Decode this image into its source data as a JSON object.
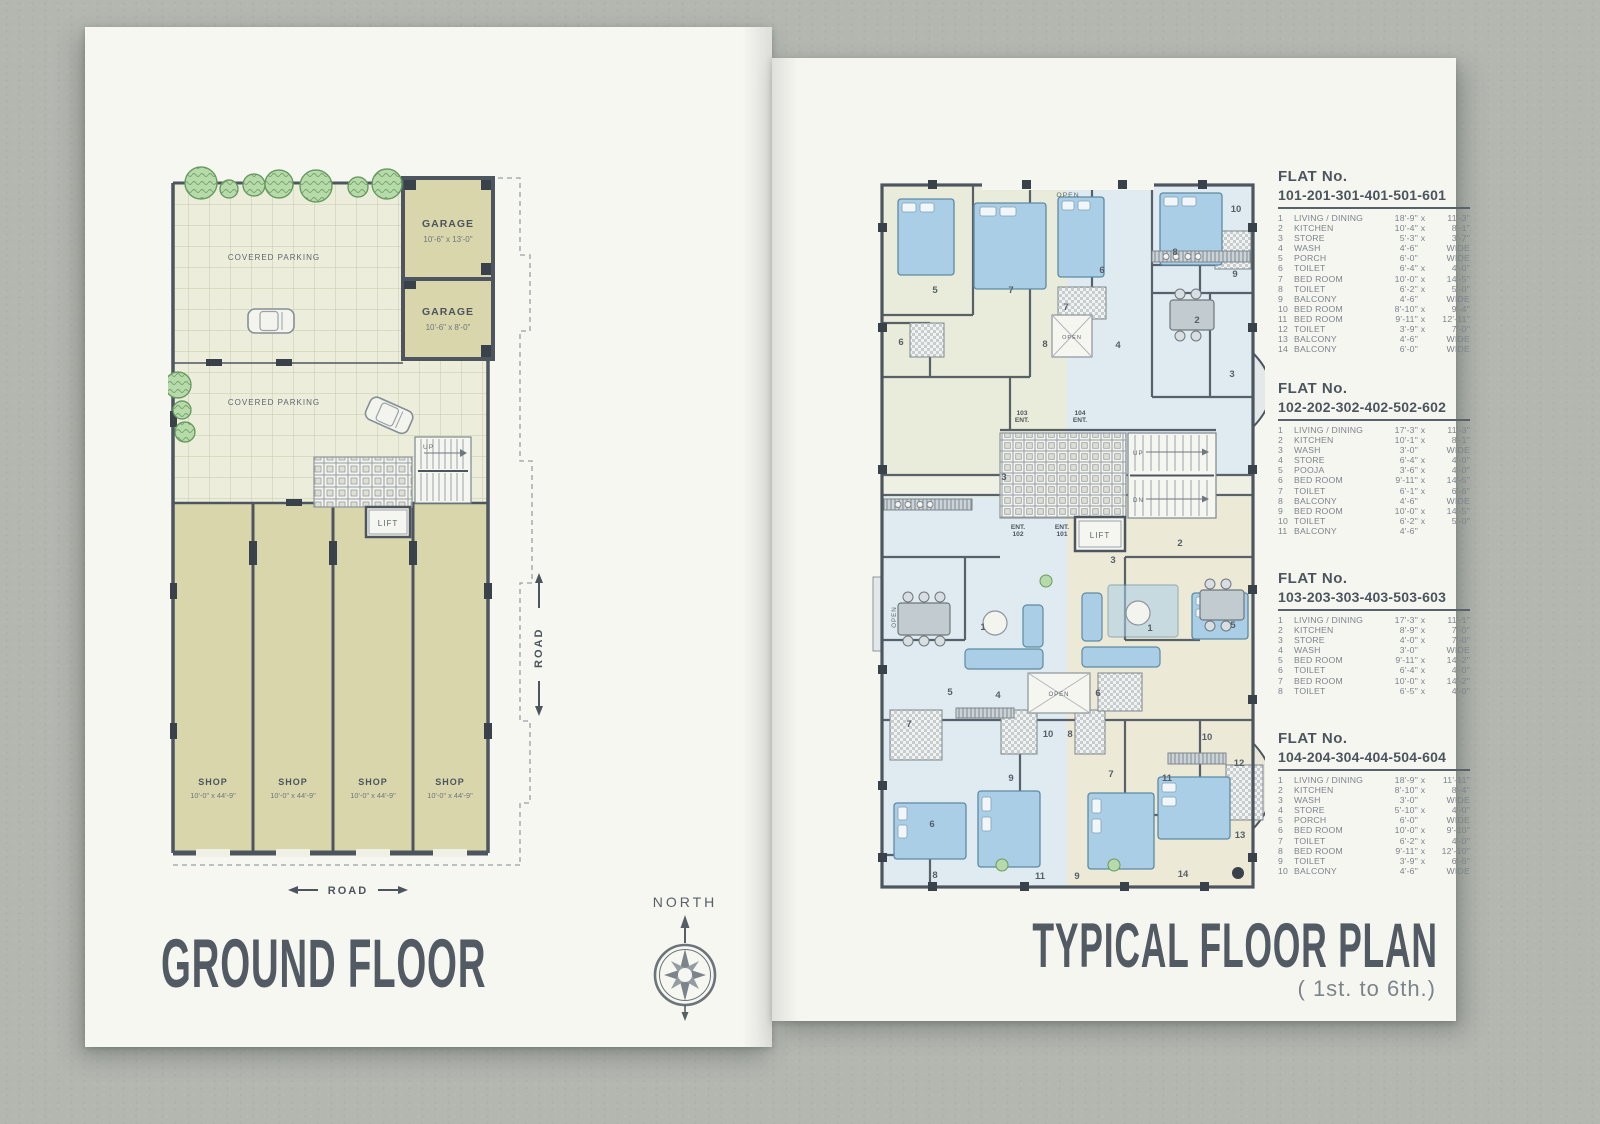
{
  "left_page": {
    "title": "GROUND FLOOR",
    "plan": {
      "covered_parking_1": "COVERED PARKING",
      "covered_parking_2": "COVERED PARKING",
      "garages": [
        {
          "name": "GARAGE",
          "dims": "10'-6\" x 13'-0\""
        },
        {
          "name": "GARAGE",
          "dims": "10'-6\" x 8'-0\""
        }
      ],
      "shops": [
        {
          "name": "SHOP",
          "dims": "10'-0\" x 44'-9\""
        },
        {
          "name": "SHOP",
          "dims": "10'-0\" x 44'-9\""
        },
        {
          "name": "SHOP",
          "dims": "10'-0\" x 44'-9\""
        },
        {
          "name": "SHOP",
          "dims": "10'-0\" x 44'-9\""
        }
      ],
      "lift": "LIFT",
      "up": "UP",
      "road_right": "ROAD",
      "road_bottom": "ROAD"
    }
  },
  "compass": {
    "label": "NORTH"
  },
  "right_page": {
    "title": "TYPICAL FLOOR PLAN",
    "subtitle": "( 1st. to 6th.)",
    "plan": {
      "open_top": "OPEN",
      "open_left": "OPEN",
      "open_well_1": "OPEN",
      "open_well_2": "OPEN",
      "ent_103": "103 ENT.",
      "ent_104": "104 ENT.",
      "ent_102": "ENT. 102",
      "ent_101": "ENT. 101",
      "lift": "LIFT",
      "up": "UP",
      "dn": "DN",
      "room_numbers": [
        "5",
        "7",
        "6",
        "7",
        "8",
        "4",
        "6",
        "8",
        "10",
        "9",
        "2",
        "3",
        "3",
        "2",
        "3",
        "1",
        "1",
        "5",
        "5",
        "4",
        "6",
        "7",
        "10",
        "8",
        "10",
        "9",
        "7",
        "11",
        "12",
        "6",
        "13",
        "8",
        "11",
        "9",
        "14"
      ]
    },
    "flats": [
      {
        "heading": "FLAT No.",
        "numbers": "101-201-301-401-501-601",
        "rows": [
          [
            "1",
            "LIVING / DINING",
            "18'-9\"",
            "x",
            "11'-3\""
          ],
          [
            "2",
            "KITCHEN",
            "10'-4\"",
            "x",
            "8'-1\""
          ],
          [
            "3",
            "STORE",
            "5'-3\"",
            "x",
            "3'-7\""
          ],
          [
            "4",
            "WASH",
            "4'-6\"",
            "",
            "WIDE"
          ],
          [
            "5",
            "PORCH",
            "6'-0\"",
            "",
            "WIDE"
          ],
          [
            "6",
            "TOILET",
            "6'-4\"",
            "x",
            "4'-0\""
          ],
          [
            "7",
            "BED ROOM",
            "10'-0\"",
            "x",
            "14'-5\""
          ],
          [
            "8",
            "TOILET",
            "6'-2\"",
            "x",
            "5'-0\""
          ],
          [
            "9",
            "BALCONY",
            "4'-6\"",
            "",
            "WIDE"
          ],
          [
            "10",
            "BED ROOM",
            "8'-10\"",
            "x",
            "9'-4\""
          ],
          [
            "11",
            "BED ROOM",
            "9'-11\"",
            "x",
            "12'-11\""
          ],
          [
            "12",
            "TOILET",
            "3'-9\"",
            "x",
            "7'-0\""
          ],
          [
            "13",
            "BALCONY",
            "4'-6\"",
            "",
            "WIDE"
          ],
          [
            "14",
            "BALCONY",
            "6'-0\"",
            "",
            "WIDE"
          ]
        ]
      },
      {
        "heading": "FLAT No.",
        "numbers": "102-202-302-402-502-602",
        "rows": [
          [
            "1",
            "LIVING / DINING",
            "17'-3\"",
            "x",
            "11'-3\""
          ],
          [
            "2",
            "KITCHEN",
            "10'-1\"",
            "x",
            "8'-1\""
          ],
          [
            "3",
            "WASH",
            "3'-0\"",
            "",
            "WIDE"
          ],
          [
            "4",
            "STORE",
            "6'-4\"",
            "x",
            "4'-0\""
          ],
          [
            "5",
            "POOJA",
            "3'-6\"",
            "x",
            "4'-0\""
          ],
          [
            "6",
            "BED ROOM",
            "9'-11\"",
            "x",
            "14'-5\""
          ],
          [
            "7",
            "TOILET",
            "6'-1\"",
            "x",
            "6'-6\""
          ],
          [
            "8",
            "BALCONY",
            "4'-6\"",
            "",
            "WIDE"
          ],
          [
            "9",
            "BED ROOM",
            "10'-0\"",
            "x",
            "14'-5\""
          ],
          [
            "10",
            "TOILET",
            "6'-2\"",
            "x",
            "5'-0\""
          ],
          [
            "11",
            "BALCONY",
            "4'-6\"",
            "",
            ""
          ]
        ]
      },
      {
        "heading": "FLAT No.",
        "numbers": "103-203-303-403-503-603",
        "rows": [
          [
            "1",
            "LIVING / DINING",
            "17'-3\"",
            "x",
            "11'-1\""
          ],
          [
            "2",
            "KITCHEN",
            "8'-9\"",
            "x",
            "7'-0\""
          ],
          [
            "3",
            "STORE",
            "4'-0\"",
            "x",
            "7'-0\""
          ],
          [
            "4",
            "WASH",
            "3'-0\"",
            "",
            "WIDE"
          ],
          [
            "5",
            "BED ROOM",
            "9'-11\"",
            "x",
            "14'-2\""
          ],
          [
            "6",
            "TOILET",
            "6'-4\"",
            "x",
            "4'-0\""
          ],
          [
            "7",
            "BED ROOM",
            "10'-0\"",
            "x",
            "14'-2\""
          ],
          [
            "8",
            "TOILET",
            "6'-5\"",
            "x",
            "4'-0\""
          ]
        ]
      },
      {
        "heading": "FLAT No.",
        "numbers": "104-204-304-404-504-604",
        "rows": [
          [
            "1",
            "LIVING / DINING",
            "18'-9\"",
            "x",
            "11'-11\""
          ],
          [
            "2",
            "KITCHEN",
            "8'-10\"",
            "x",
            "8'-4\""
          ],
          [
            "3",
            "WASH",
            "3'-0\"",
            "",
            "WIDE"
          ],
          [
            "4",
            "STORE",
            "5'-10\"",
            "x",
            "4'-0\""
          ],
          [
            "5",
            "PORCH",
            "6'-0\"",
            "",
            "WIDE"
          ],
          [
            "6",
            "BED ROOM",
            "10'-0\"",
            "x",
            "9'-10\""
          ],
          [
            "7",
            "TOILET",
            "6'-2\"",
            "x",
            "4'-0\""
          ],
          [
            "8",
            "BED ROOM",
            "9'-11\"",
            "x",
            "12'-10\""
          ],
          [
            "9",
            "TOILET",
            "3'-9\"",
            "x",
            "6'-6\""
          ],
          [
            "10",
            "BALCONY",
            "4'-6\"",
            "",
            "WIDE"
          ]
        ]
      }
    ]
  }
}
